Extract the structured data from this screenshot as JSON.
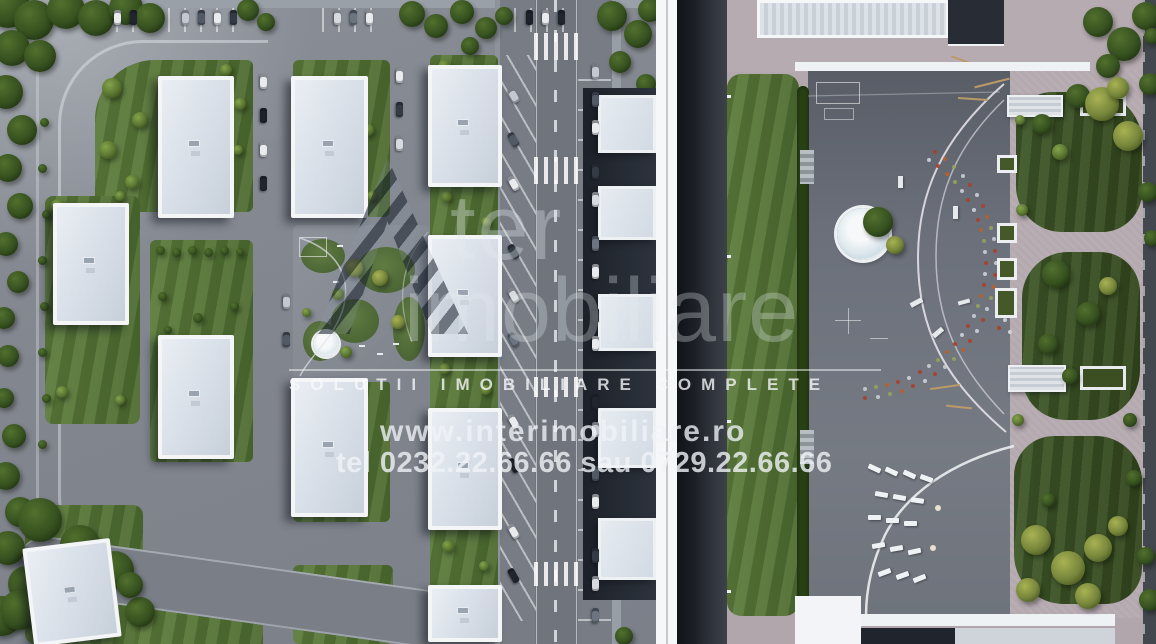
{
  "watermark": {
    "logo_fragment": "ter",
    "brand_word": "imobiliare",
    "tagline": "SOLUTII IMOBILIARE COMPLETE",
    "website": "www.interimobiliare.ro",
    "phone": "tel 0232.22.66.66 sau 0729.22.66.66"
  },
  "scene": {
    "left_panel": "aerial-site-plan",
    "right_panel": "courtyard-garden-closeup",
    "colors": {
      "road": "#7f848c",
      "lawn": "#557434",
      "forest": "#2c421c",
      "pavement_pink": "#b4a8af",
      "plaza": "#6e737b",
      "building_white": "#f3f5f7",
      "watermark_text": "#eef2f6"
    }
  }
}
